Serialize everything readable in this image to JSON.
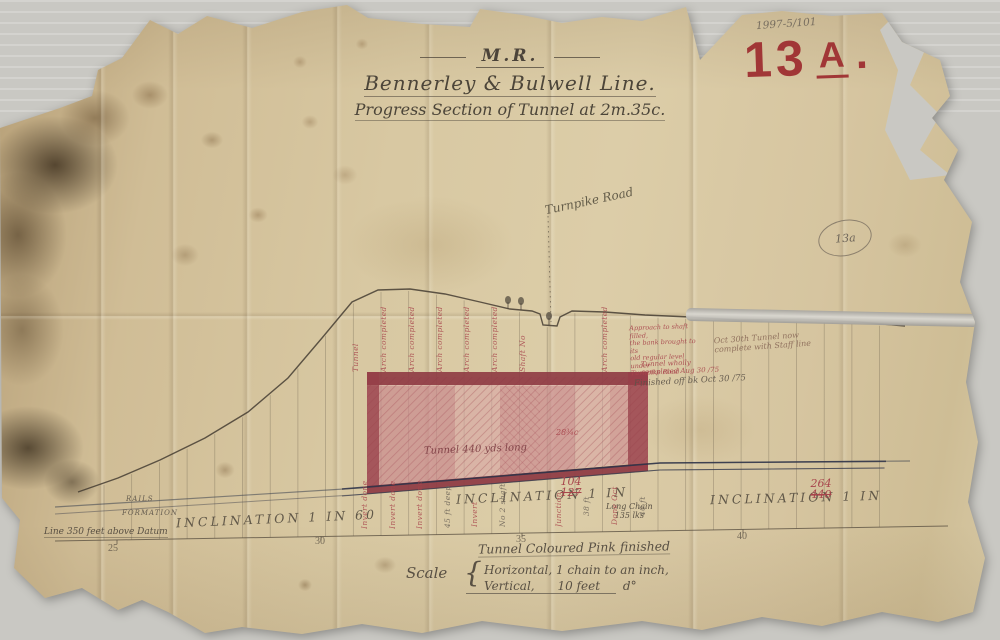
{
  "refs": {
    "archive_ref": "1997-5/101",
    "sheet_number": "13",
    "sheet_letter": "A",
    "sheet_dot": ".",
    "pencil_circle_ref": "13a"
  },
  "title": {
    "railway_initials": "M.R.",
    "line_name": "Bennerley & Bulwell Line.",
    "drawing_title": "Progress Section of Tunnel at 2m.35c."
  },
  "labels": {
    "road": "Turnpike Road",
    "rails": "RAILS",
    "formation": "FORMATION",
    "datum": "Line 350 feet above Datum",
    "inclination_1": "INCLINATION 1 IN 60",
    "inclination_2": "INCLINATION 1 IN",
    "inclination_2_revised": "104",
    "inclination_2_original": "127",
    "inclination_3": "INCLINATION 1 IN",
    "inclination_3_revised": "264",
    "inclination_3_original": "440",
    "long_chain": "Long Chain\n135 lks",
    "tunnel_length": "Tunnel 440 yds long",
    "chainage_mark": "28¾c",
    "legend": "Tunnel Coloured Pink finished",
    "scale_word": "Scale",
    "scale_brace": "{",
    "scale_horizontal": "Horizontal, 1 chain to an inch,",
    "scale_vertical": "Vertical,      10 feet      d°"
  },
  "ticks": {
    "t1": "25",
    "t2": "30",
    "t3": "35",
    "t4": "40"
  },
  "annotations": {
    "shaft_note": "Approach to shaft filled,\nthe bank brought to its\nold regular level under\nTurnpike Road",
    "completion_red": "Tunnel wholly\ncompleted Aug 30 /75",
    "completion_black": "Finished off bk Oct 30 /75",
    "pencil_note": "Oct 30th Tunnel now\ncomplete with Staff line"
  },
  "progress_notes": [
    {
      "text": "Tunnel commenced Augt 7.72",
      "x": 350,
      "y": 296,
      "h": 76,
      "style": "red"
    },
    {
      "text": "Arch completed Feb 10.73",
      "x": 378,
      "y": 291,
      "h": 81,
      "style": "red"
    },
    {
      "text": "Arch completed Dec 30.72",
      "x": 406,
      "y": 292,
      "h": 80,
      "style": "red"
    },
    {
      "text": "Arch completed Jan 16.73",
      "x": 434,
      "y": 294,
      "h": 78,
      "style": "red"
    },
    {
      "text": "Arch completed Nov 9.72",
      "x": 461,
      "y": 299,
      "h": 73,
      "style": "red"
    },
    {
      "text": "Arch completed Oct 4.72",
      "x": 489,
      "y": 305,
      "h": 67,
      "style": "red"
    },
    {
      "text": "Shaft No 2",
      "x": 517,
      "y": 331,
      "h": 41,
      "style": "red"
    },
    {
      "text": "Arch completed Sep 18.72",
      "x": 599,
      "y": 303,
      "h": 69,
      "style": "red"
    },
    {
      "text": "Invert done Mar 3.73",
      "x": 359,
      "y": 477,
      "h": 52,
      "style": "red"
    },
    {
      "text": "Invert done Feb 12.73",
      "x": 387,
      "y": 477,
      "h": 52,
      "style": "red"
    },
    {
      "text": "Invert done Jan 8.73",
      "x": 414,
      "y": 479,
      "h": 50,
      "style": "red"
    },
    {
      "text": "45 ft deep",
      "x": 442,
      "y": 480,
      "h": 48,
      "style": "pencil"
    },
    {
      "text": "Invert done Apr 2.73",
      "x": 469,
      "y": 480,
      "h": 47,
      "style": "red"
    },
    {
      "text": "No 2 shaft",
      "x": 497,
      "y": 481,
      "h": 46,
      "style": "pencil"
    },
    {
      "text": "Junction length",
      "x": 553,
      "y": 483,
      "h": 44,
      "style": "red"
    },
    {
      "text": "38 ft",
      "x": 581,
      "y": 486,
      "h": 30,
      "style": "pencil"
    },
    {
      "text": "Done Oct 73",
      "x": 609,
      "y": 485,
      "h": 40,
      "style": "red"
    },
    {
      "text": "40 ft",
      "x": 637,
      "y": 488,
      "h": 28,
      "style": "pencil"
    }
  ]
}
